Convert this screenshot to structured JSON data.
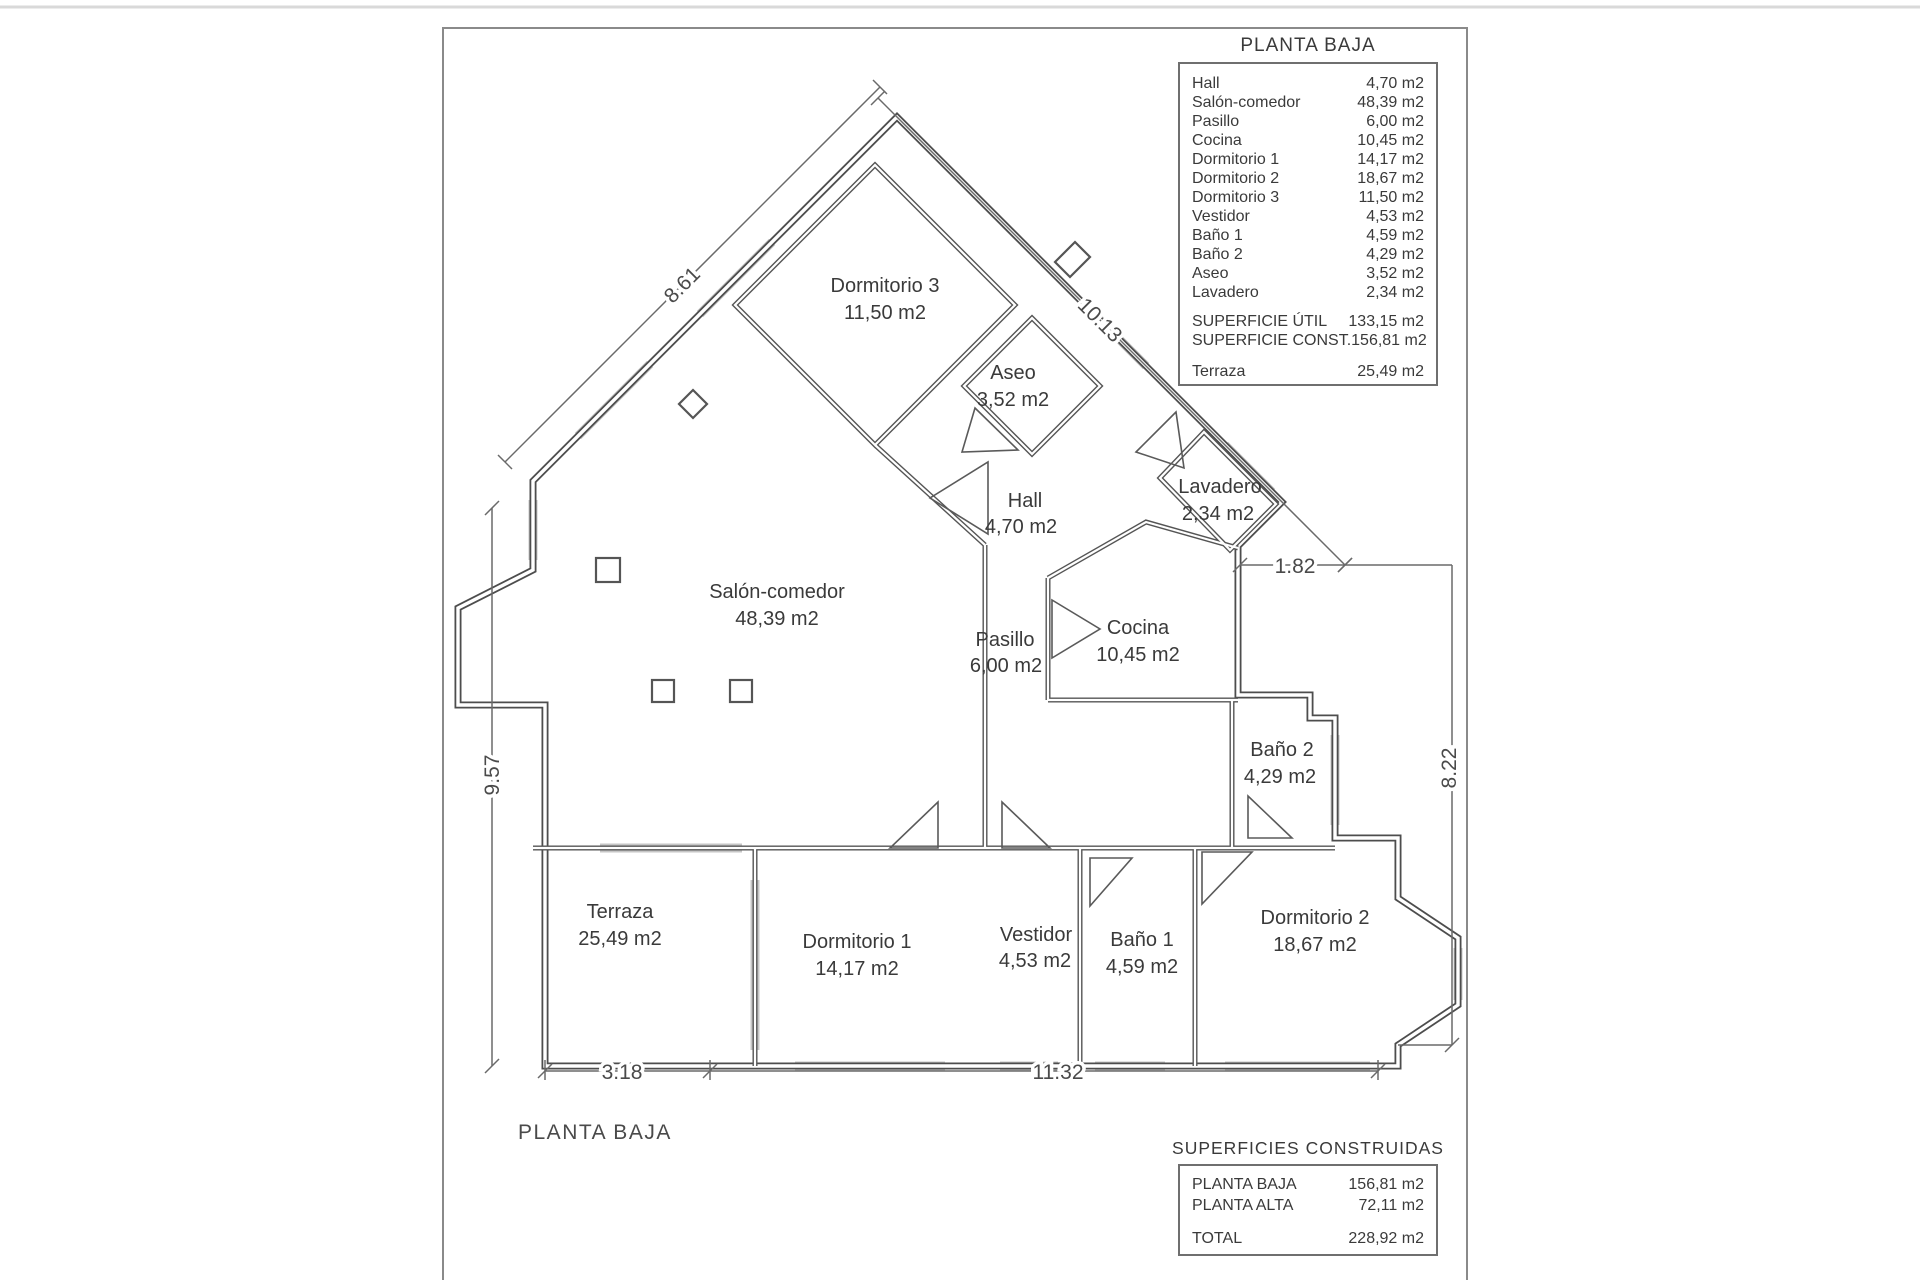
{
  "legend": {
    "title": "PLANTA BAJA",
    "rows": [
      {
        "label": "Hall",
        "value": "4,70 m2"
      },
      {
        "label": "Salón-comedor",
        "value": "48,39 m2"
      },
      {
        "label": "Pasillo",
        "value": "6,00 m2"
      },
      {
        "label": "Cocina",
        "value": "10,45 m2"
      },
      {
        "label": "Dormitorio 1",
        "value": "14,17 m2"
      },
      {
        "label": "Dormitorio 2",
        "value": "18,67 m2"
      },
      {
        "label": "Dormitorio 3",
        "value": "11,50 m2"
      },
      {
        "label": "Vestidor",
        "value": "4,53 m2"
      },
      {
        "label": "Baño 1",
        "value": "4,59 m2"
      },
      {
        "label": "Baño 2",
        "value": "4,29 m2"
      },
      {
        "label": "Aseo",
        "value": "3,52 m2"
      },
      {
        "label": "Lavadero",
        "value": "2,34 m2"
      }
    ],
    "totals": [
      {
        "label": "SUPERFICIE ÚTIL",
        "value": "133,15 m2"
      },
      {
        "label": "SUPERFICIE CONST.",
        "value": "156,81 m2"
      }
    ],
    "terraza": {
      "label": "Terraza",
      "value": "25,49 m2"
    }
  },
  "rooms": {
    "dormitorio3": {
      "name": "Dormitorio 3",
      "area": "11,50 m2"
    },
    "aseo": {
      "name": "Aseo",
      "area": "3,52 m2"
    },
    "hall": {
      "name": "Hall",
      "area": "4,70 m2"
    },
    "lavadero": {
      "name": "Lavadero",
      "area": "2,34 m2"
    },
    "salon": {
      "name": "Salón-comedor",
      "area": "48,39 m2"
    },
    "pasillo": {
      "name": "Pasillo",
      "area": "6,00 m2"
    },
    "cocina": {
      "name": "Cocina",
      "area": "10,45 m2"
    },
    "bano2": {
      "name": "Baño 2",
      "area": "4,29 m2"
    },
    "terraza": {
      "name": "Terraza",
      "area": "25,49 m2"
    },
    "dormitorio1": {
      "name": "Dormitorio 1",
      "area": "14,17 m2"
    },
    "vestidor": {
      "name": "Vestidor",
      "area": "4,53 m2"
    },
    "bano1": {
      "name": "Baño 1",
      "area": "4,59 m2"
    },
    "dormitorio2": {
      "name": "Dormitorio 2",
      "area": "18,67 m2"
    }
  },
  "dimensions": {
    "diag_left": "8.61",
    "diag_right": "10.13",
    "left_height": "9.57",
    "lavadero_offset": "1.82",
    "right_height": "8.22",
    "bottom_left": "3.18",
    "bottom_main": "11.32"
  },
  "summary": {
    "title": "SUPERFICIES CONSTRUIDAS",
    "rows": [
      {
        "label": "PLANTA BAJA",
        "value": "156,81 m2"
      },
      {
        "label": "PLANTA ALTA",
        "value": "72,11 m2"
      }
    ],
    "total": {
      "label": "TOTAL",
      "value": "228,92 m2"
    }
  },
  "footer": {
    "plan_label": "PLANTA BAJA"
  }
}
